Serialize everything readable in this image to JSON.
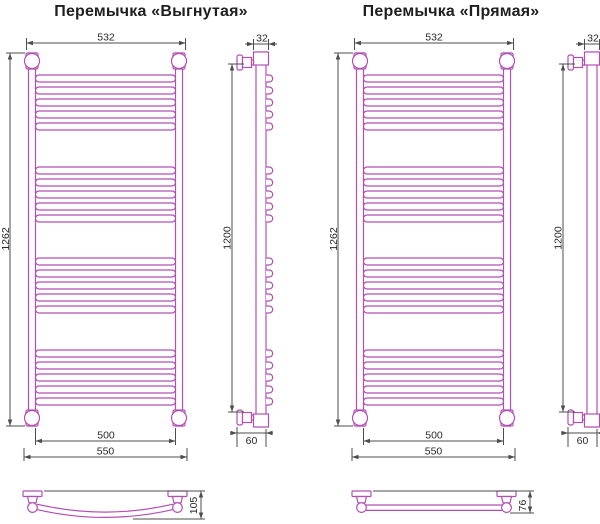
{
  "colors": {
    "product": "#b34fb3",
    "dimension": "#4d4d4d",
    "text": "#2a2a2a",
    "background": "#ffffff"
  },
  "drawings": [
    {
      "title": "Перемычка «Выгнутая»",
      "crossbar": "curved",
      "rungs": {
        "groups": 4,
        "per_group": 5
      },
      "dims": {
        "top_width": "532",
        "side_depth": "32",
        "overall_height": "1262",
        "rail_height": "1200",
        "rung_width": "500",
        "overall_width": "550",
        "wall_offset": "60",
        "crossbar_depth": "105"
      }
    },
    {
      "title": "Перемычка «Прямая»",
      "crossbar": "straight",
      "rungs": {
        "groups": 4,
        "per_group": 5
      },
      "dims": {
        "top_width": "532",
        "side_depth": "32",
        "overall_height": "1262",
        "rail_height": "1200",
        "rung_width": "500",
        "overall_width": "550",
        "wall_offset": "60",
        "crossbar_depth": "76"
      }
    }
  ]
}
